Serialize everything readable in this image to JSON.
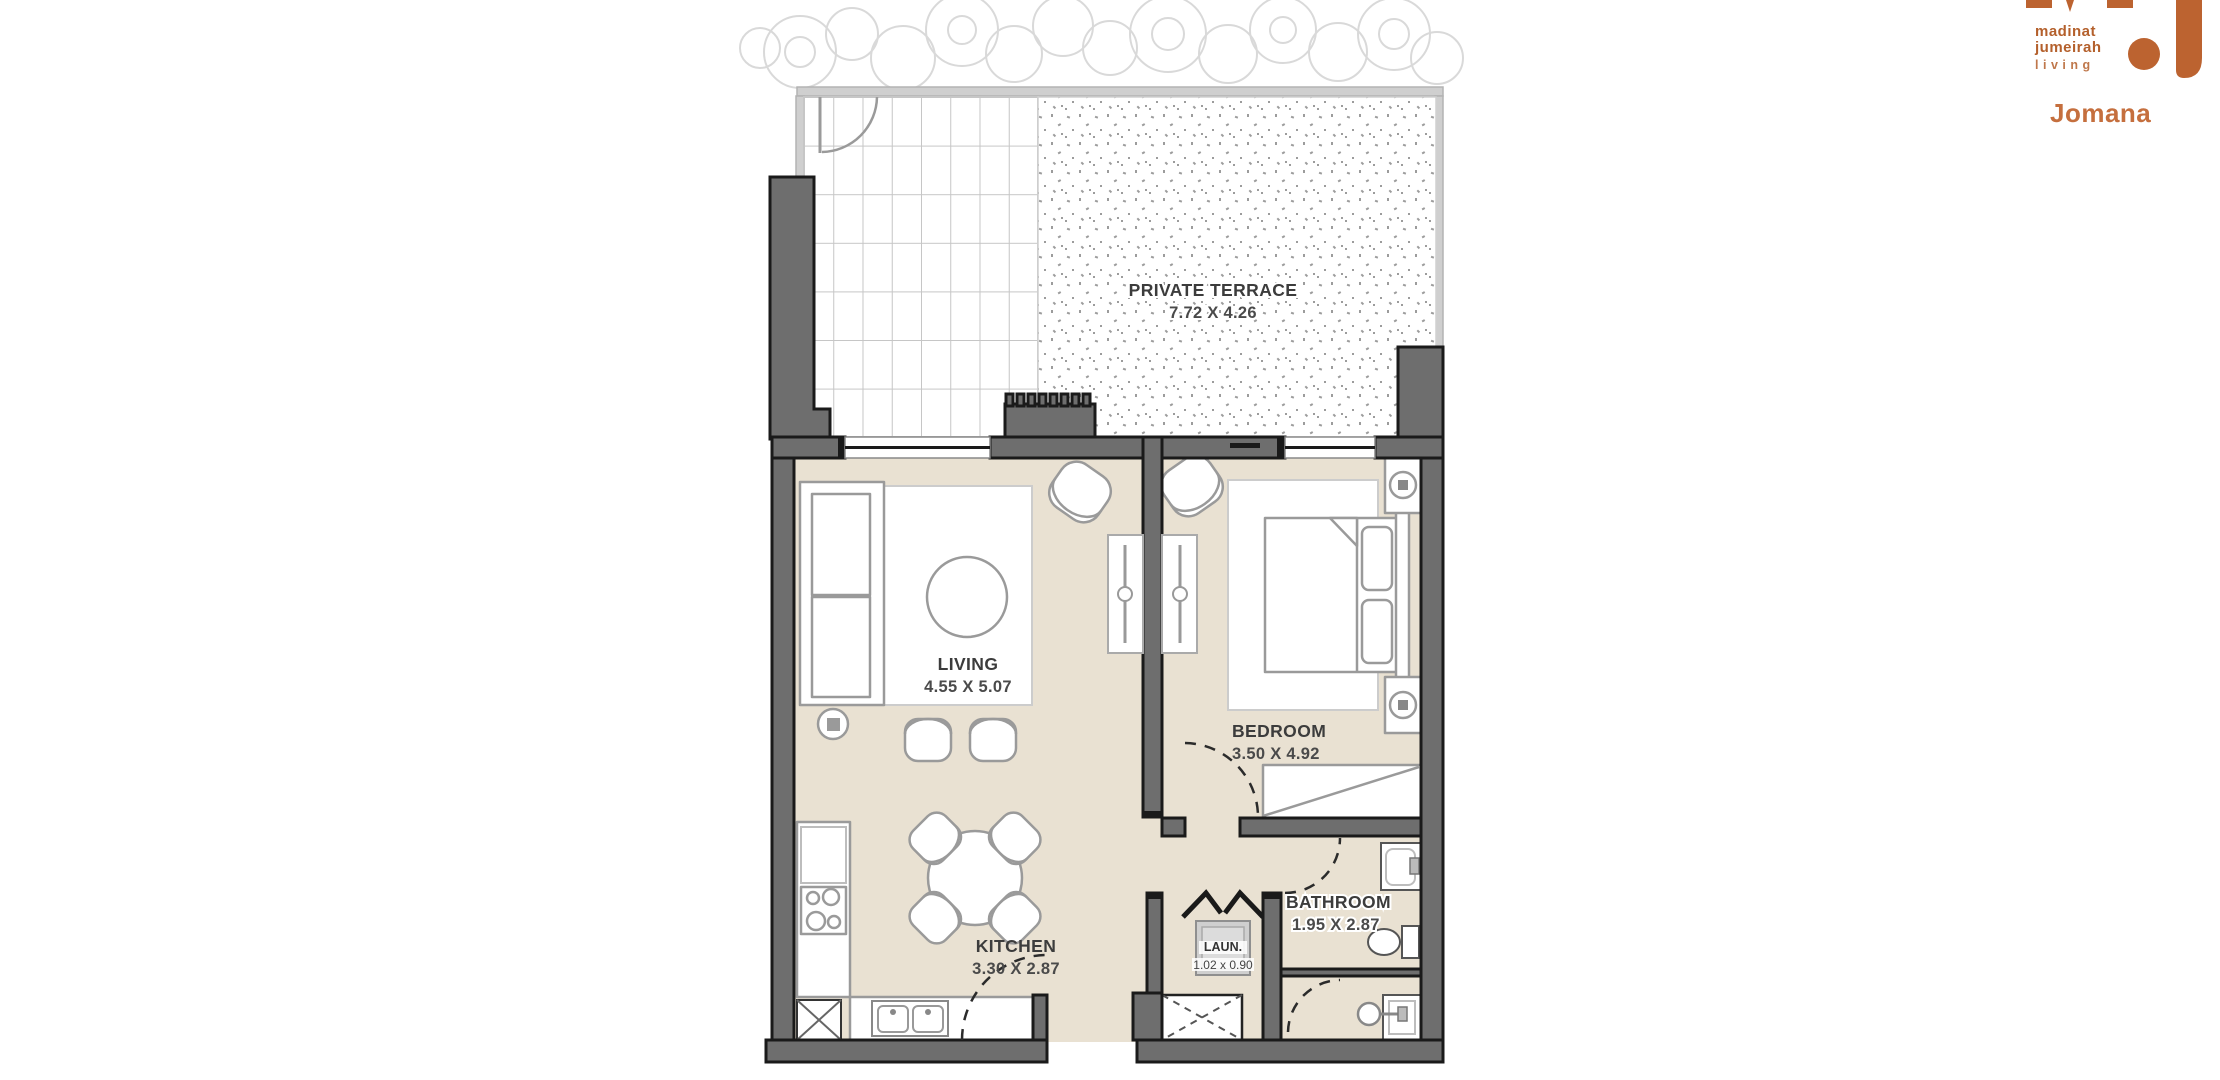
{
  "brand": {
    "monogram": "MJ",
    "name_lines": [
      "madinat",
      "jumeirah",
      "living"
    ],
    "project": "Jomana",
    "orange": "#BC6330",
    "orange_light": "#C56F3E"
  },
  "plan": {
    "colors": {
      "wall": "#6E6E6E",
      "wall_outline": "#1A1A1A",
      "floor": "#E9E1D2",
      "fence": "#CFCFCF",
      "grid_line": "#C6C6C6",
      "stipple_dot": "#9C9C9C",
      "furniture_stroke": "#9A9A9A",
      "label_text": "#3C3C3C"
    },
    "terrace": {
      "label": "PRIVATE TERRACE",
      "dims": "7.72 X 4.26"
    },
    "living": {
      "label": "LIVING",
      "dims": "4.55 X 5.07"
    },
    "bedroom": {
      "label": "BEDROOM",
      "dims": "3.50 X 4.92"
    },
    "kitchen": {
      "label": "KITCHEN",
      "dims": "3.30 X 2.87"
    },
    "bathroom": {
      "label": "BATHROOM",
      "dims": "1.95 X 2.87"
    },
    "laundry": {
      "label": "LAUN.",
      "dims": "1.02 x 0.90"
    }
  }
}
